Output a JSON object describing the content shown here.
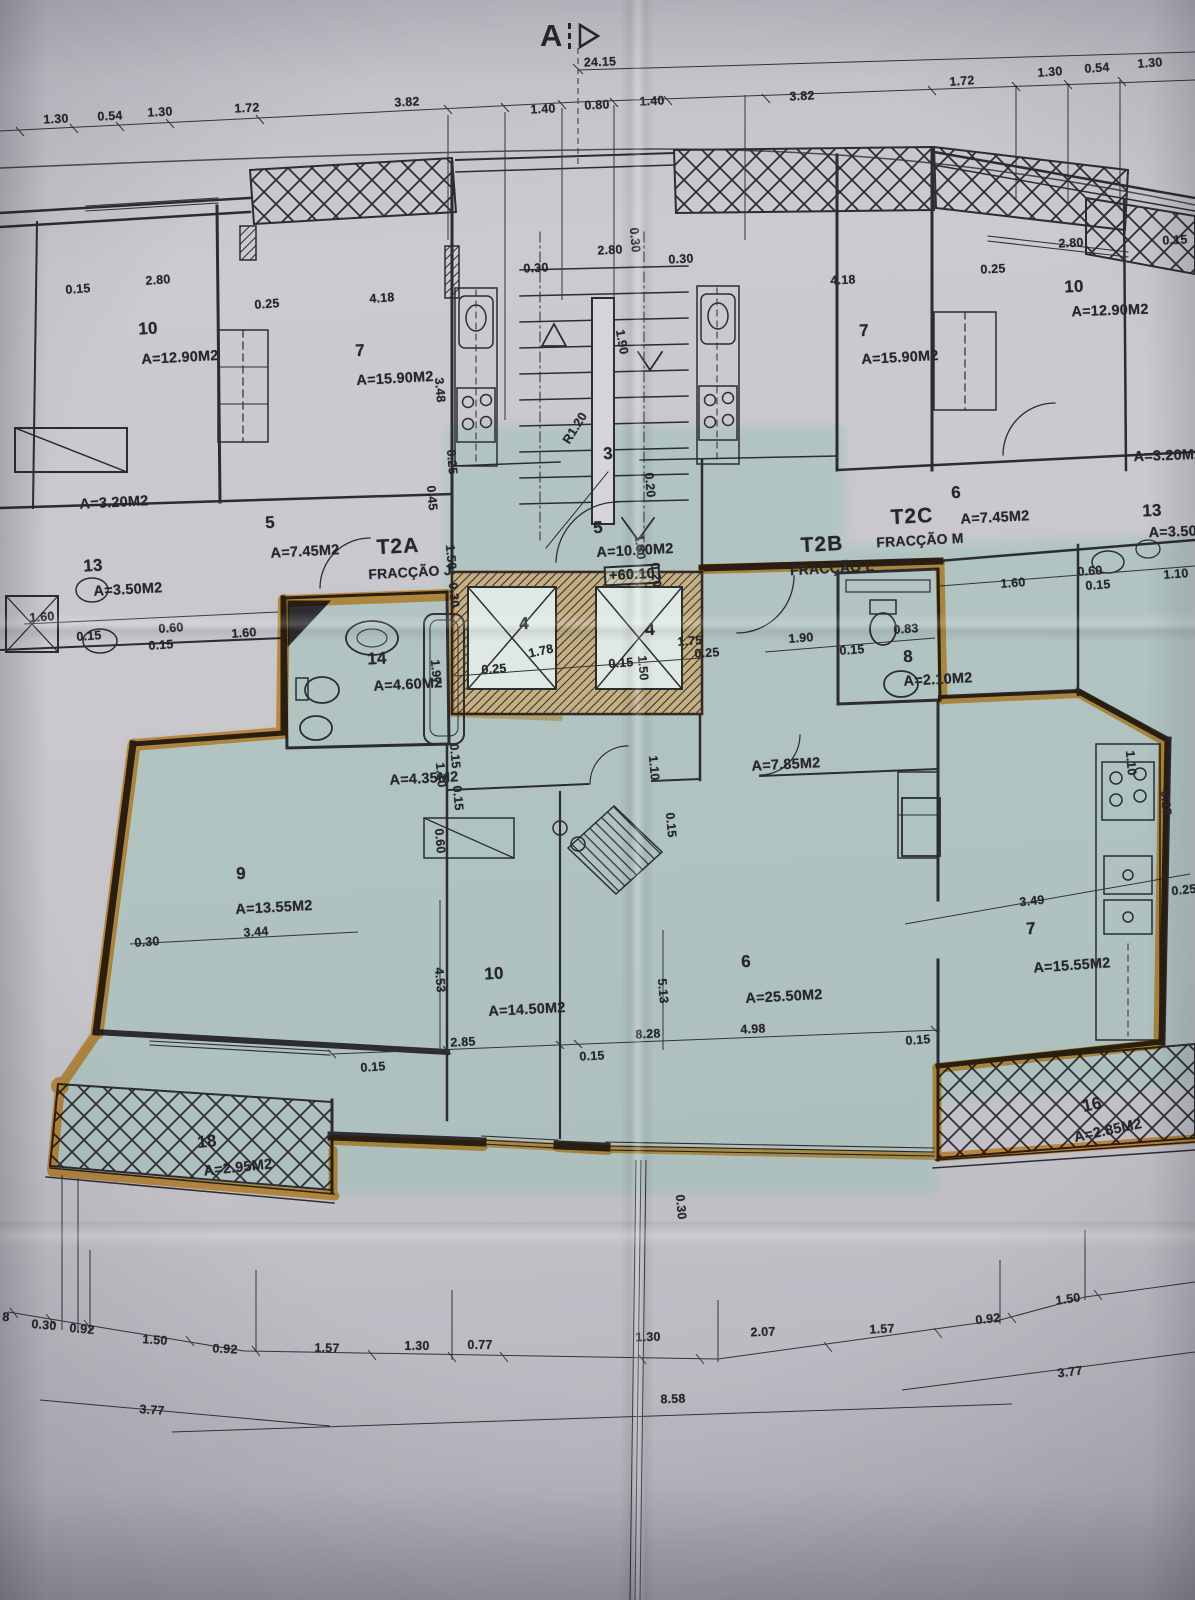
{
  "document": {
    "kind": "architectural floor plan photo",
    "section_letter": "A",
    "overall_width": "24.15",
    "level_marker": "+60.10"
  },
  "palette": {
    "paper": "#c7c5cb",
    "highlight_tint": "#8fbfb2",
    "marker_orange": "#f09c2c",
    "ink": "#26262b"
  },
  "fractions": [
    {
      "code": "T2A",
      "name": "FRACÇÃO J"
    },
    {
      "code": "T2B",
      "name": "FRACÇÃO L"
    },
    {
      "code": "T2C",
      "name": "FRACÇÃO M"
    }
  ],
  "rooms": [
    {
      "number": "10",
      "area": "A=12.90M2",
      "wing": "upper-left"
    },
    {
      "number": "7",
      "area": "A=15.90M2",
      "wing": "upper-left"
    },
    {
      "number": "",
      "area": "A=3.20M2",
      "wing": "upper-left"
    },
    {
      "number": "5",
      "area": "A=7.45M2",
      "wing": "upper-left"
    },
    {
      "number": "13",
      "area": "A=3.50M2",
      "wing": "upper-left"
    },
    {
      "number": "3",
      "area": "",
      "wing": "stairwell"
    },
    {
      "number": "5",
      "area": "A=10.50M2",
      "wing": "center"
    },
    {
      "number": "4",
      "area": "",
      "wing": "elevator"
    },
    {
      "number": "4",
      "area": "",
      "wing": "elevator"
    },
    {
      "number": "14",
      "area": "A=4.60M2",
      "wing": "t2b"
    },
    {
      "number": "8",
      "area": "A=2.10M2",
      "wing": "t2b"
    },
    {
      "number": "",
      "area": "A=4.35M2",
      "wing": "t2b"
    },
    {
      "number": "",
      "area": "A=7.85M2",
      "wing": "t2b"
    },
    {
      "number": "9",
      "area": "A=13.55M2",
      "wing": "t2b"
    },
    {
      "number": "10",
      "area": "A=14.50M2",
      "wing": "t2b"
    },
    {
      "number": "6",
      "area": "A=25.50M2",
      "wing": "t2b"
    },
    {
      "number": "7",
      "area": "A=15.55M2",
      "wing": "t2b"
    },
    {
      "number": "18",
      "area": "A=2.95M2",
      "wing": "t2b"
    },
    {
      "number": "16",
      "area": "A=2.85M2",
      "wing": "t2b"
    },
    {
      "number": "10",
      "area": "A=12.90M2",
      "wing": "upper-right"
    },
    {
      "number": "7",
      "area": "A=15.90M2",
      "wing": "upper-right"
    },
    {
      "number": "",
      "area": "A=3.20M2",
      "wing": "upper-right"
    },
    {
      "number": "6",
      "area": "A=7.45M2",
      "wing": "upper-right"
    },
    {
      "number": "13",
      "area": "A=3.50M2",
      "wing": "upper-right"
    }
  ],
  "labels": [
    {
      "t": "24.15",
      "x": 600,
      "y": 62,
      "r": -2
    },
    {
      "t": "1.30",
      "x": 56,
      "y": 119,
      "r": -3
    },
    {
      "t": "0.54",
      "x": 110,
      "y": 116,
      "r": -3
    },
    {
      "t": "1.30",
      "x": 160,
      "y": 112,
      "r": -3
    },
    {
      "t": "1.72",
      "x": 247,
      "y": 108,
      "r": -3
    },
    {
      "t": "3.82",
      "x": 407,
      "y": 102,
      "r": -3
    },
    {
      "t": "1.40",
      "x": 543,
      "y": 109,
      "r": -3
    },
    {
      "t": "0.80",
      "x": 597,
      "y": 105,
      "r": -3
    },
    {
      "t": "1.40",
      "x": 652,
      "y": 101,
      "r": -3
    },
    {
      "t": "3.82",
      "x": 802,
      "y": 96,
      "r": -3
    },
    {
      "t": "1.72",
      "x": 962,
      "y": 81,
      "r": -4
    },
    {
      "t": "1.30",
      "x": 1050,
      "y": 72,
      "r": -4
    },
    {
      "t": "0.54",
      "x": 1097,
      "y": 68,
      "r": -4
    },
    {
      "t": "1.30",
      "x": 1150,
      "y": 63,
      "r": -4
    },
    {
      "t": "0.15",
      "x": 78,
      "y": 289,
      "r": -4
    },
    {
      "t": "2.80",
      "x": 158,
      "y": 280,
      "r": -4
    },
    {
      "t": "0.25",
      "x": 267,
      "y": 304,
      "r": -4
    },
    {
      "t": "4.18",
      "x": 382,
      "y": 298,
      "r": -4
    },
    {
      "t": "3.48",
      "x": 440,
      "y": 390,
      "r": 85
    },
    {
      "t": "10",
      "x": 148,
      "y": 329,
      "k": "num",
      "r": -3
    },
    {
      "t": "A=12.90M2",
      "x": 180,
      "y": 358,
      "k": "area",
      "r": -3
    },
    {
      "t": "7",
      "x": 360,
      "y": 351,
      "k": "num",
      "r": -3
    },
    {
      "t": "A=15.90M2",
      "x": 395,
      "y": 379,
      "k": "area",
      "r": -3
    },
    {
      "t": "A=3.20M2",
      "x": 114,
      "y": 503,
      "k": "area",
      "r": -3
    },
    {
      "t": "5",
      "x": 270,
      "y": 523,
      "k": "num",
      "r": -3
    },
    {
      "t": "A=7.45M2",
      "x": 305,
      "y": 552,
      "k": "area",
      "r": -3
    },
    {
      "t": "13",
      "x": 93,
      "y": 566,
      "k": "num",
      "r": -3
    },
    {
      "t": "A=3.50M2",
      "x": 128,
      "y": 590,
      "k": "area",
      "r": -3
    },
    {
      "t": "1.60",
      "x": 42,
      "y": 617,
      "r": -4
    },
    {
      "t": "0.15",
      "x": 89,
      "y": 636,
      "r": -4
    },
    {
      "t": "0.60",
      "x": 171,
      "y": 628,
      "r": -4
    },
    {
      "t": "0.15",
      "x": 161,
      "y": 645,
      "r": -4
    },
    {
      "t": "1.60",
      "x": 244,
      "y": 633,
      "r": -4
    },
    {
      "t": "0.30",
      "x": 536,
      "y": 268,
      "r": -3
    },
    {
      "t": "2.80",
      "x": 610,
      "y": 250,
      "r": -3
    },
    {
      "t": "0.30",
      "x": 681,
      "y": 259,
      "r": -3
    },
    {
      "t": "0.30",
      "x": 635,
      "y": 240,
      "r": 85
    },
    {
      "t": "1.90",
      "x": 622,
      "y": 342,
      "r": 80
    },
    {
      "t": "3",
      "x": 608,
      "y": 454,
      "k": "num",
      "r": -3
    },
    {
      "t": "R1.20",
      "x": 575,
      "y": 428,
      "r": -58
    },
    {
      "t": "0.25",
      "x": 452,
      "y": 462,
      "r": 85
    },
    {
      "t": "0.45",
      "x": 432,
      "y": 498,
      "r": 85
    },
    {
      "t": "1.50",
      "x": 451,
      "y": 557,
      "r": 85
    },
    {
      "t": "0.30",
      "x": 454,
      "y": 595,
      "r": 85
    },
    {
      "t": "0.20",
      "x": 650,
      "y": 485,
      "r": 85
    },
    {
      "t": "5",
      "x": 598,
      "y": 528,
      "k": "num",
      "r": -3
    },
    {
      "t": "A=10.50M2",
      "x": 635,
      "y": 551,
      "k": "area",
      "r": -3
    },
    {
      "t": "+60.10",
      "x": 632,
      "y": 575,
      "k": "lvl",
      "r": -3
    },
    {
      "t": "1.50",
      "x": 640,
      "y": 547,
      "r": 85
    },
    {
      "t": "0.20",
      "x": 656,
      "y": 575,
      "r": 85
    },
    {
      "t": "4",
      "x": 524,
      "y": 624,
      "k": "num",
      "r": -3
    },
    {
      "t": "1.78",
      "x": 541,
      "y": 651,
      "r": -12
    },
    {
      "t": "0.25",
      "x": 494,
      "y": 669,
      "r": -4
    },
    {
      "t": "0.15",
      "x": 621,
      "y": 663,
      "r": -4
    },
    {
      "t": "1.50",
      "x": 643,
      "y": 668,
      "r": 85
    },
    {
      "t": "4",
      "x": 650,
      "y": 630,
      "k": "num",
      "r": -3
    },
    {
      "t": "1.75",
      "x": 690,
      "y": 641,
      "r": -4
    },
    {
      "t": "0.25",
      "x": 707,
      "y": 653,
      "r": -4
    },
    {
      "t": "1.97",
      "x": 436,
      "y": 672,
      "r": 85
    },
    {
      "t": "14",
      "x": 377,
      "y": 659,
      "k": "num",
      "r": -3
    },
    {
      "t": "A=4.60M2",
      "x": 408,
      "y": 685,
      "k": "area",
      "r": -3
    },
    {
      "t": "T2A",
      "x": 398,
      "y": 547,
      "k": "fr",
      "r": -3
    },
    {
      "t": "FRACÇÃO J",
      "x": 410,
      "y": 572,
      "k": "frs",
      "r": -3
    },
    {
      "t": "T2B",
      "x": 822,
      "y": 545,
      "k": "fr",
      "r": -3
    },
    {
      "t": "FRACÇÃO L",
      "x": 832,
      "y": 568,
      "k": "frs",
      "r": -3
    },
    {
      "t": "T2C",
      "x": 912,
      "y": 517,
      "k": "fr",
      "r": -3
    },
    {
      "t": "FRACÇÃO M",
      "x": 920,
      "y": 540,
      "k": "frs",
      "r": -3
    },
    {
      "t": "1.90",
      "x": 801,
      "y": 638,
      "r": -4
    },
    {
      "t": "0.15",
      "x": 852,
      "y": 650,
      "r": -4
    },
    {
      "t": "0.83",
      "x": 906,
      "y": 629,
      "r": -4
    },
    {
      "t": "8",
      "x": 908,
      "y": 657,
      "k": "num",
      "r": -3
    },
    {
      "t": "A=2.10M2",
      "x": 938,
      "y": 680,
      "k": "area",
      "r": -3
    },
    {
      "t": "1.60",
      "x": 1013,
      "y": 583,
      "r": -4
    },
    {
      "t": "0.60",
      "x": 1090,
      "y": 571,
      "r": -4
    },
    {
      "t": "0.15",
      "x": 1098,
      "y": 585,
      "r": -4
    },
    {
      "t": "1.10",
      "x": 1176,
      "y": 574,
      "r": -4
    },
    {
      "t": "4.18",
      "x": 843,
      "y": 280,
      "r": -3
    },
    {
      "t": "0.25",
      "x": 993,
      "y": 269,
      "r": -3
    },
    {
      "t": "2.80",
      "x": 1071,
      "y": 243,
      "r": -3
    },
    {
      "t": "0.15",
      "x": 1175,
      "y": 240,
      "r": -3
    },
    {
      "t": "10",
      "x": 1074,
      "y": 287,
      "k": "num",
      "r": -2
    },
    {
      "t": "A=12.90M2",
      "x": 1110,
      "y": 311,
      "k": "area",
      "r": -2
    },
    {
      "t": "7",
      "x": 864,
      "y": 331,
      "k": "num",
      "r": -3
    },
    {
      "t": "A=15.90M2",
      "x": 900,
      "y": 358,
      "k": "area",
      "r": -3
    },
    {
      "t": "A=3.20M2",
      "x": 1168,
      "y": 456,
      "k": "area",
      "r": -2
    },
    {
      "t": "6",
      "x": 956,
      "y": 493,
      "k": "num",
      "r": -3
    },
    {
      "t": "A=7.45M2",
      "x": 995,
      "y": 518,
      "k": "area",
      "r": -3
    },
    {
      "t": "13",
      "x": 1152,
      "y": 511,
      "k": "num",
      "r": -2
    },
    {
      "t": "A=3.50M2",
      "x": 1183,
      "y": 532,
      "k": "area",
      "r": -2
    },
    {
      "t": "A=4.35M2",
      "x": 424,
      "y": 779,
      "k": "area",
      "r": -3
    },
    {
      "t": "1.10",
      "x": 441,
      "y": 775,
      "r": 85
    },
    {
      "t": "0.15",
      "x": 455,
      "y": 756,
      "r": 85
    },
    {
      "t": "0.15",
      "x": 458,
      "y": 798,
      "r": 85
    },
    {
      "t": "0.60",
      "x": 440,
      "y": 841,
      "r": 85
    },
    {
      "t": "A=7.85M2",
      "x": 786,
      "y": 765,
      "k": "area",
      "r": -3
    },
    {
      "t": "1.10",
      "x": 654,
      "y": 768,
      "r": 85
    },
    {
      "t": "1.10",
      "x": 1131,
      "y": 763,
      "r": 85
    },
    {
      "t": "0.15",
      "x": 671,
      "y": 825,
      "r": 85
    },
    {
      "t": "0.15",
      "x": 1166,
      "y": 803,
      "r": 85
    },
    {
      "t": "9",
      "x": 241,
      "y": 874,
      "k": "num",
      "r": -3
    },
    {
      "t": "A=13.55M2",
      "x": 274,
      "y": 908,
      "k": "area",
      "r": -3
    },
    {
      "t": "3.44",
      "x": 256,
      "y": 932,
      "r": -4
    },
    {
      "t": "0.30",
      "x": 147,
      "y": 942,
      "r": -4
    },
    {
      "t": "10",
      "x": 494,
      "y": 974,
      "k": "num",
      "r": -3
    },
    {
      "t": "A=14.50M2",
      "x": 527,
      "y": 1010,
      "k": "area",
      "r": -3
    },
    {
      "t": "4.53",
      "x": 440,
      "y": 980,
      "r": 85
    },
    {
      "t": "2.85",
      "x": 463,
      "y": 1042,
      "r": -3
    },
    {
      "t": "0.15",
      "x": 592,
      "y": 1056,
      "r": -3
    },
    {
      "t": "6",
      "x": 746,
      "y": 962,
      "k": "num",
      "r": -3
    },
    {
      "t": "A=25.50M2",
      "x": 784,
      "y": 997,
      "k": "area",
      "r": -3
    },
    {
      "t": "5.13",
      "x": 663,
      "y": 991,
      "r": 85
    },
    {
      "t": "8.28",
      "x": 648,
      "y": 1034,
      "r": -3
    },
    {
      "t": "4.98",
      "x": 753,
      "y": 1029,
      "r": -3
    },
    {
      "t": "7",
      "x": 1031,
      "y": 929,
      "k": "num",
      "r": -4
    },
    {
      "t": "A=15.55M2",
      "x": 1072,
      "y": 966,
      "k": "area",
      "r": -4
    },
    {
      "t": "3.49",
      "x": 1032,
      "y": 901,
      "r": -6
    },
    {
      "t": "0.25",
      "x": 1184,
      "y": 890,
      "r": -6
    },
    {
      "t": "0.15",
      "x": 918,
      "y": 1040,
      "r": -4
    },
    {
      "t": "0.15",
      "x": 373,
      "y": 1067,
      "r": -4
    },
    {
      "t": "18",
      "x": 207,
      "y": 1142,
      "k": "num",
      "r": -6
    },
    {
      "t": "A=2.95M2",
      "x": 238,
      "y": 1168,
      "k": "area",
      "r": -6
    },
    {
      "t": "16",
      "x": 1092,
      "y": 1105,
      "k": "num",
      "r": -12
    },
    {
      "t": "A=2.85M2",
      "x": 1108,
      "y": 1131,
      "k": "area",
      "r": -12
    },
    {
      "t": "0.30",
      "x": 681,
      "y": 1207,
      "r": 85
    },
    {
      "t": "8",
      "x": 6,
      "y": 1317,
      "r": 4
    },
    {
      "t": "0.30",
      "x": 44,
      "y": 1325,
      "r": 5
    },
    {
      "t": "0.92",
      "x": 82,
      "y": 1329,
      "r": 5
    },
    {
      "t": "1.50",
      "x": 155,
      "y": 1340,
      "r": 4
    },
    {
      "t": "0.92",
      "x": 225,
      "y": 1349,
      "r": 3
    },
    {
      "t": "1.57",
      "x": 327,
      "y": 1348,
      "r": 1
    },
    {
      "t": "1.30",
      "x": 417,
      "y": 1346,
      "r": 0
    },
    {
      "t": "0.77",
      "x": 480,
      "y": 1345,
      "r": 0
    },
    {
      "t": "1.30",
      "x": 648,
      "y": 1337,
      "r": -1
    },
    {
      "t": "2.07",
      "x": 763,
      "y": 1332,
      "r": -2
    },
    {
      "t": "1.57",
      "x": 882,
      "y": 1329,
      "r": -3
    },
    {
      "t": "0.92",
      "x": 988,
      "y": 1319,
      "r": -6
    },
    {
      "t": "1.50",
      "x": 1068,
      "y": 1299,
      "r": -8
    },
    {
      "t": "3.77",
      "x": 152,
      "y": 1410,
      "r": 4
    },
    {
      "t": "8.58",
      "x": 673,
      "y": 1399,
      "r": -2
    },
    {
      "t": "3.77",
      "x": 1070,
      "y": 1372,
      "r": -7
    }
  ]
}
